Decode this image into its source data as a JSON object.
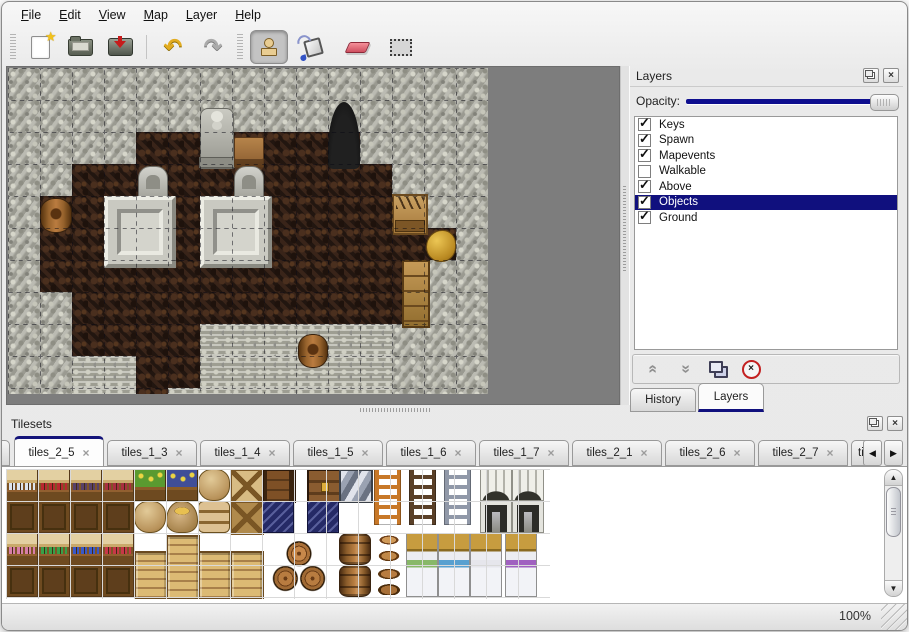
{
  "icons": {
    "close": "×",
    "check": "✓",
    "undo": "↶",
    "redo": "↷",
    "chevrons": "«",
    "chevrons_r": "»",
    "tri_left": "◀",
    "tri_right": "▶",
    "tri_up": "▲",
    "tri_down": "▼",
    "star": "★"
  },
  "colors": {
    "selection_navy": "#10107e",
    "slider_track_navy": "#0f0f8f",
    "canvas_gray": "#7d7d7d",
    "active_tab_top": "#14147a"
  },
  "menu": {
    "items": [
      {
        "label": "File"
      },
      {
        "label": "Edit"
      },
      {
        "label": "View"
      },
      {
        "label": "Map"
      },
      {
        "label": "Layer"
      },
      {
        "label": "Help"
      }
    ]
  },
  "toolbar": {
    "file_group": [
      "new-file",
      "open-folder",
      "save"
    ],
    "history_group": [
      "undo",
      "redo"
    ],
    "tools": [
      {
        "name": "stamp",
        "active": true
      },
      {
        "name": "fill-bucket",
        "active": false
      },
      {
        "name": "eraser",
        "active": false
      },
      {
        "name": "select-rect",
        "active": false
      }
    ]
  },
  "layers_panel": {
    "title": "Layers",
    "opacity_label": "Opacity:",
    "opacity_value": 100,
    "layers": [
      {
        "name": "Keys",
        "visible": true,
        "selected": false
      },
      {
        "name": "Spawn",
        "visible": true,
        "selected": false
      },
      {
        "name": "Mapevents",
        "visible": true,
        "selected": false
      },
      {
        "name": "Walkable",
        "visible": false,
        "selected": false
      },
      {
        "name": "Above",
        "visible": true,
        "selected": false
      },
      {
        "name": "Objects",
        "visible": true,
        "selected": true
      },
      {
        "name": "Ground",
        "visible": true,
        "selected": false
      }
    ],
    "buttons": [
      "raise-layer",
      "lower-layer",
      "duplicate-layer",
      "delete-layer"
    ],
    "tabs": [
      {
        "label": "History",
        "active": false
      },
      {
        "label": "Layers",
        "active": true
      }
    ]
  },
  "tilesets_panel": {
    "title": "Tilesets",
    "tabs": [
      {
        "label": "tiles_2_5",
        "active": true
      },
      {
        "label": "tiles_1_3",
        "active": false
      },
      {
        "label": "tiles_1_4",
        "active": false
      },
      {
        "label": "tiles_1_5",
        "active": false
      },
      {
        "label": "tiles_1_6",
        "active": false
      },
      {
        "label": "tiles_1_7",
        "active": false
      },
      {
        "label": "tiles_2_1",
        "active": false
      },
      {
        "label": "tiles_2_6",
        "active": false
      },
      {
        "label": "tiles_2_7",
        "active": false
      },
      {
        "label": "tiles_",
        "active": false,
        "truncated": true
      }
    ]
  },
  "status_bar": {
    "zoom": "100%"
  },
  "map": {
    "tile_size": 32,
    "legend": {
      "W": "stone-wall",
      "F": "dark-floor",
      "R": "stone-rubble"
    },
    "rows": [
      "WWWWWWWWWWWWWWW",
      "WWWWWWWWWWWWWWW",
      "WWWWFFFFFFFWWWW",
      "WWFFFFFFFFFFWWW",
      "WFFFFFFFFFFFFWW",
      "WFFFFFFFFFFFFFW",
      "WFFFFFFFFFFFFWW",
      "WWFFFFFFFFFFFWW",
      "WWFFFFRRRRRRWWW",
      "WWRRFFRRRRRRWWW",
      "WWRRFRRRRRRRWWW"
    ],
    "objects": [
      {
        "type": "statue",
        "x": 6,
        "y": 1.25,
        "w": 1,
        "h": 1.85
      },
      {
        "type": "table",
        "x": 7.05,
        "y": 2.15,
        "w": 0.9,
        "h": 0.9
      },
      {
        "type": "entrance",
        "x": 10,
        "y": 1.05,
        "w": 1,
        "h": 2.1
      },
      {
        "type": "headstone",
        "x": 4.05,
        "y": 3.05,
        "w": 0.9,
        "h": 1
      },
      {
        "type": "headstone",
        "x": 7.05,
        "y": 3.05,
        "w": 0.9,
        "h": 1
      },
      {
        "type": "tombslab",
        "x": 3,
        "y": 4,
        "w": 2,
        "h": 2
      },
      {
        "type": "tombslab",
        "x": 6,
        "y": 4,
        "w": 2,
        "h": 2
      },
      {
        "type": "barrel",
        "x": 1,
        "y": 4.05,
        "w": 0.95,
        "h": 1.05
      },
      {
        "type": "cratetools",
        "x": 12,
        "y": 3.95,
        "w": 1,
        "h": 1.15
      },
      {
        "type": "goldsack",
        "x": 13.05,
        "y": 5.05,
        "w": 0.9,
        "h": 0.95
      },
      {
        "type": "cabinet",
        "x": 12.3,
        "y": 6,
        "w": 0.75,
        "h": 2
      },
      {
        "type": "barrel",
        "x": 9.05,
        "y": 8.3,
        "w": 0.9,
        "h": 1
      }
    ]
  },
  "palette": {
    "tile_size": 32,
    "items": [
      {
        "type": "shelf",
        "col": 0,
        "row": 0,
        "w": 1,
        "h": 2,
        "accent": "#dce4ee"
      },
      {
        "type": "shelf",
        "col": 1,
        "row": 0,
        "w": 1,
        "h": 2,
        "accent": "#b82830"
      },
      {
        "type": "shelf",
        "col": 2,
        "row": 0,
        "w": 1,
        "h": 2,
        "accent": "#584068"
      },
      {
        "type": "shelf",
        "col": 3,
        "row": 0,
        "w": 1,
        "h": 2,
        "accent": "#a83040"
      },
      {
        "type": "planter",
        "col": 4,
        "row": 0,
        "w": 1,
        "h": 1,
        "accent": "#5a9a30"
      },
      {
        "type": "planter",
        "col": 5,
        "row": 0,
        "w": 1,
        "h": 1,
        "accent": "#404e98"
      },
      {
        "type": "sack",
        "col": 6,
        "row": 0,
        "w": 1,
        "h": 1
      },
      {
        "type": "cratex",
        "col": 7,
        "row": 0,
        "w": 1,
        "h": 1,
        "accent": "#d8bc84"
      },
      {
        "type": "chesttop",
        "col": 8,
        "row": 0,
        "w": 1,
        "h": 1
      },
      {
        "type": "chestfront",
        "col": 9.4,
        "row": 0,
        "w": 1,
        "h": 1
      },
      {
        "type": "steelchest",
        "col": 10.4,
        "row": 0,
        "w": 1,
        "h": 1
      },
      {
        "type": "sack",
        "col": 4,
        "row": 1,
        "w": 1,
        "h": 1
      },
      {
        "type": "sackopen",
        "col": 5,
        "row": 1,
        "w": 1,
        "h": 1
      },
      {
        "type": "sackstack",
        "col": 6,
        "row": 1,
        "w": 1,
        "h": 1
      },
      {
        "type": "cratex",
        "col": 7,
        "row": 1,
        "w": 1,
        "h": 1,
        "accent": "#b08a4c"
      },
      {
        "type": "navy",
        "col": 8,
        "row": 1,
        "w": 1,
        "h": 1
      },
      {
        "type": "navy",
        "col": 9.4,
        "row": 1,
        "w": 1,
        "h": 1
      },
      {
        "type": "ladder",
        "col": 11.5,
        "row": 0,
        "w": 0.9,
        "h": 1.8,
        "accent": "#c87828"
      },
      {
        "type": "ladder",
        "col": 12.6,
        "row": 0,
        "w": 0.9,
        "h": 1.8,
        "accent": "#5a4028"
      },
      {
        "type": "ladder",
        "col": 13.7,
        "row": 0,
        "w": 0.9,
        "h": 1.8,
        "accent": "#9098a8"
      },
      {
        "type": "archtop",
        "col": 14.8,
        "row": 0,
        "w": 1,
        "h": 1
      },
      {
        "type": "archtop",
        "col": 15.8,
        "row": 0,
        "w": 1,
        "h": 1
      },
      {
        "type": "archdoor",
        "col": 14.8,
        "row": 1,
        "w": 1,
        "h": 1
      },
      {
        "type": "archdoor",
        "col": 15.8,
        "row": 1,
        "w": 1,
        "h": 1
      },
      {
        "type": "shelf",
        "col": 0,
        "row": 2,
        "w": 1,
        "h": 2,
        "accent": "#d87ea8"
      },
      {
        "type": "shelf",
        "col": 1,
        "row": 2,
        "w": 1,
        "h": 2,
        "accent": "#38a048"
      },
      {
        "type": "shelf",
        "col": 2,
        "row": 2,
        "w": 1,
        "h": 2,
        "accent": "#3a58c8"
      },
      {
        "type": "shelf",
        "col": 3,
        "row": 2,
        "w": 1,
        "h": 2,
        "accent": "#c83848"
      },
      {
        "type": "crate",
        "col": 4,
        "row": 2.55,
        "w": 1,
        "h": 1.45
      },
      {
        "type": "crate",
        "col": 5,
        "row": 2.05,
        "w": 1,
        "h": 1.95
      },
      {
        "type": "crate",
        "col": 6,
        "row": 2.55,
        "w": 1,
        "h": 1.45
      },
      {
        "type": "crate",
        "col": 7,
        "row": 2.55,
        "w": 1,
        "h": 1.45
      },
      {
        "type": "pyramid",
        "col": 8.2,
        "row": 2.1,
        "w": 2,
        "h": 1.9
      },
      {
        "type": "barrel",
        "col": 10.4,
        "row": 2,
        "w": 1,
        "h": 1
      },
      {
        "type": "barrel",
        "col": 10.4,
        "row": 3,
        "w": 1,
        "h": 1
      },
      {
        "type": "pots",
        "col": 11.5,
        "row": 2,
        "w": 1,
        "h": 2
      },
      {
        "type": "bed",
        "col": 12.5,
        "row": 2,
        "w": 1,
        "h": 2,
        "accent": "#88b868"
      },
      {
        "type": "bed",
        "col": 13.5,
        "row": 2,
        "w": 1,
        "h": 2,
        "accent": "#58a0d0"
      },
      {
        "type": "bed",
        "col": 14.5,
        "row": 2,
        "w": 1,
        "h": 2,
        "accent": "#e6e6ec"
      },
      {
        "type": "bed",
        "col": 15.6,
        "row": 2,
        "w": 1,
        "h": 2,
        "accent": "#a060c0"
      }
    ]
  }
}
